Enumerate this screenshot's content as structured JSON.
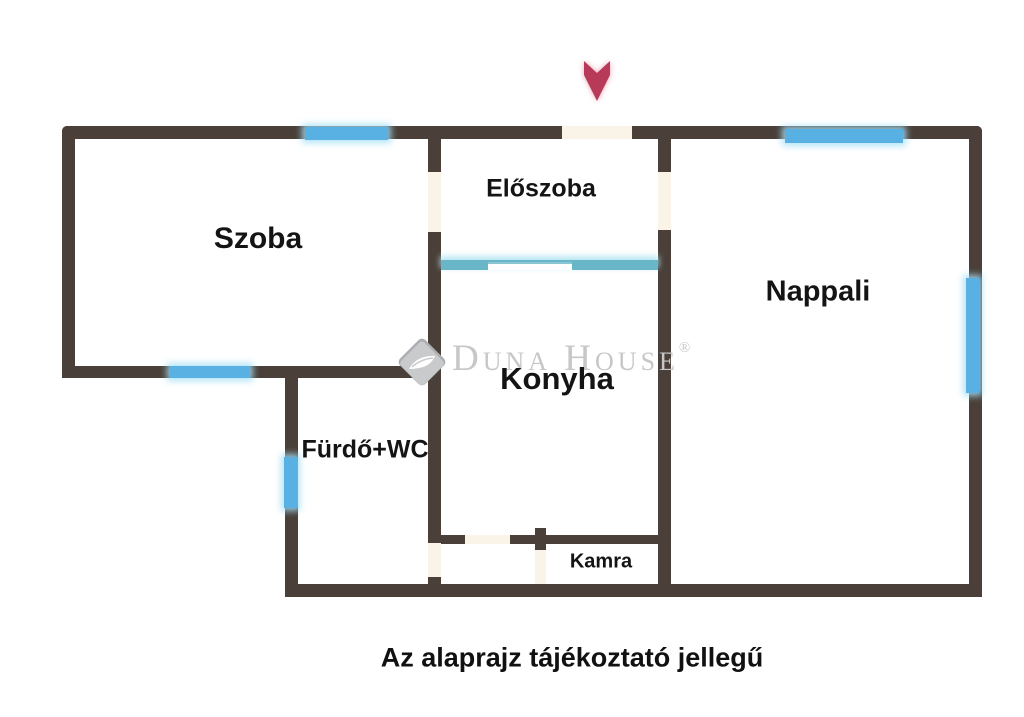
{
  "rooms": {
    "szoba": "Szoba",
    "eloszoba": "Előszoba",
    "nappali": "Nappali",
    "konyha": "Konyha",
    "furdo": "Fürdő+WC",
    "kamra": "Kamra"
  },
  "note": "Az alaprajz tájékoztató jellegű",
  "watermark": {
    "brand": "Duna House",
    "reg": "®"
  },
  "entrance": {
    "icon": "red-down-arrow",
    "meaning": "entrance"
  },
  "colors": {
    "wall": "#4a4039",
    "window_blue": "#58b1e2",
    "partition_blue": "#68b6c8",
    "door_cream": "#faf3e7",
    "background": "#ffffff",
    "watermark_gray": "#c6c7c9",
    "arrow_red": "#b73a58",
    "label_black": "#141414"
  }
}
